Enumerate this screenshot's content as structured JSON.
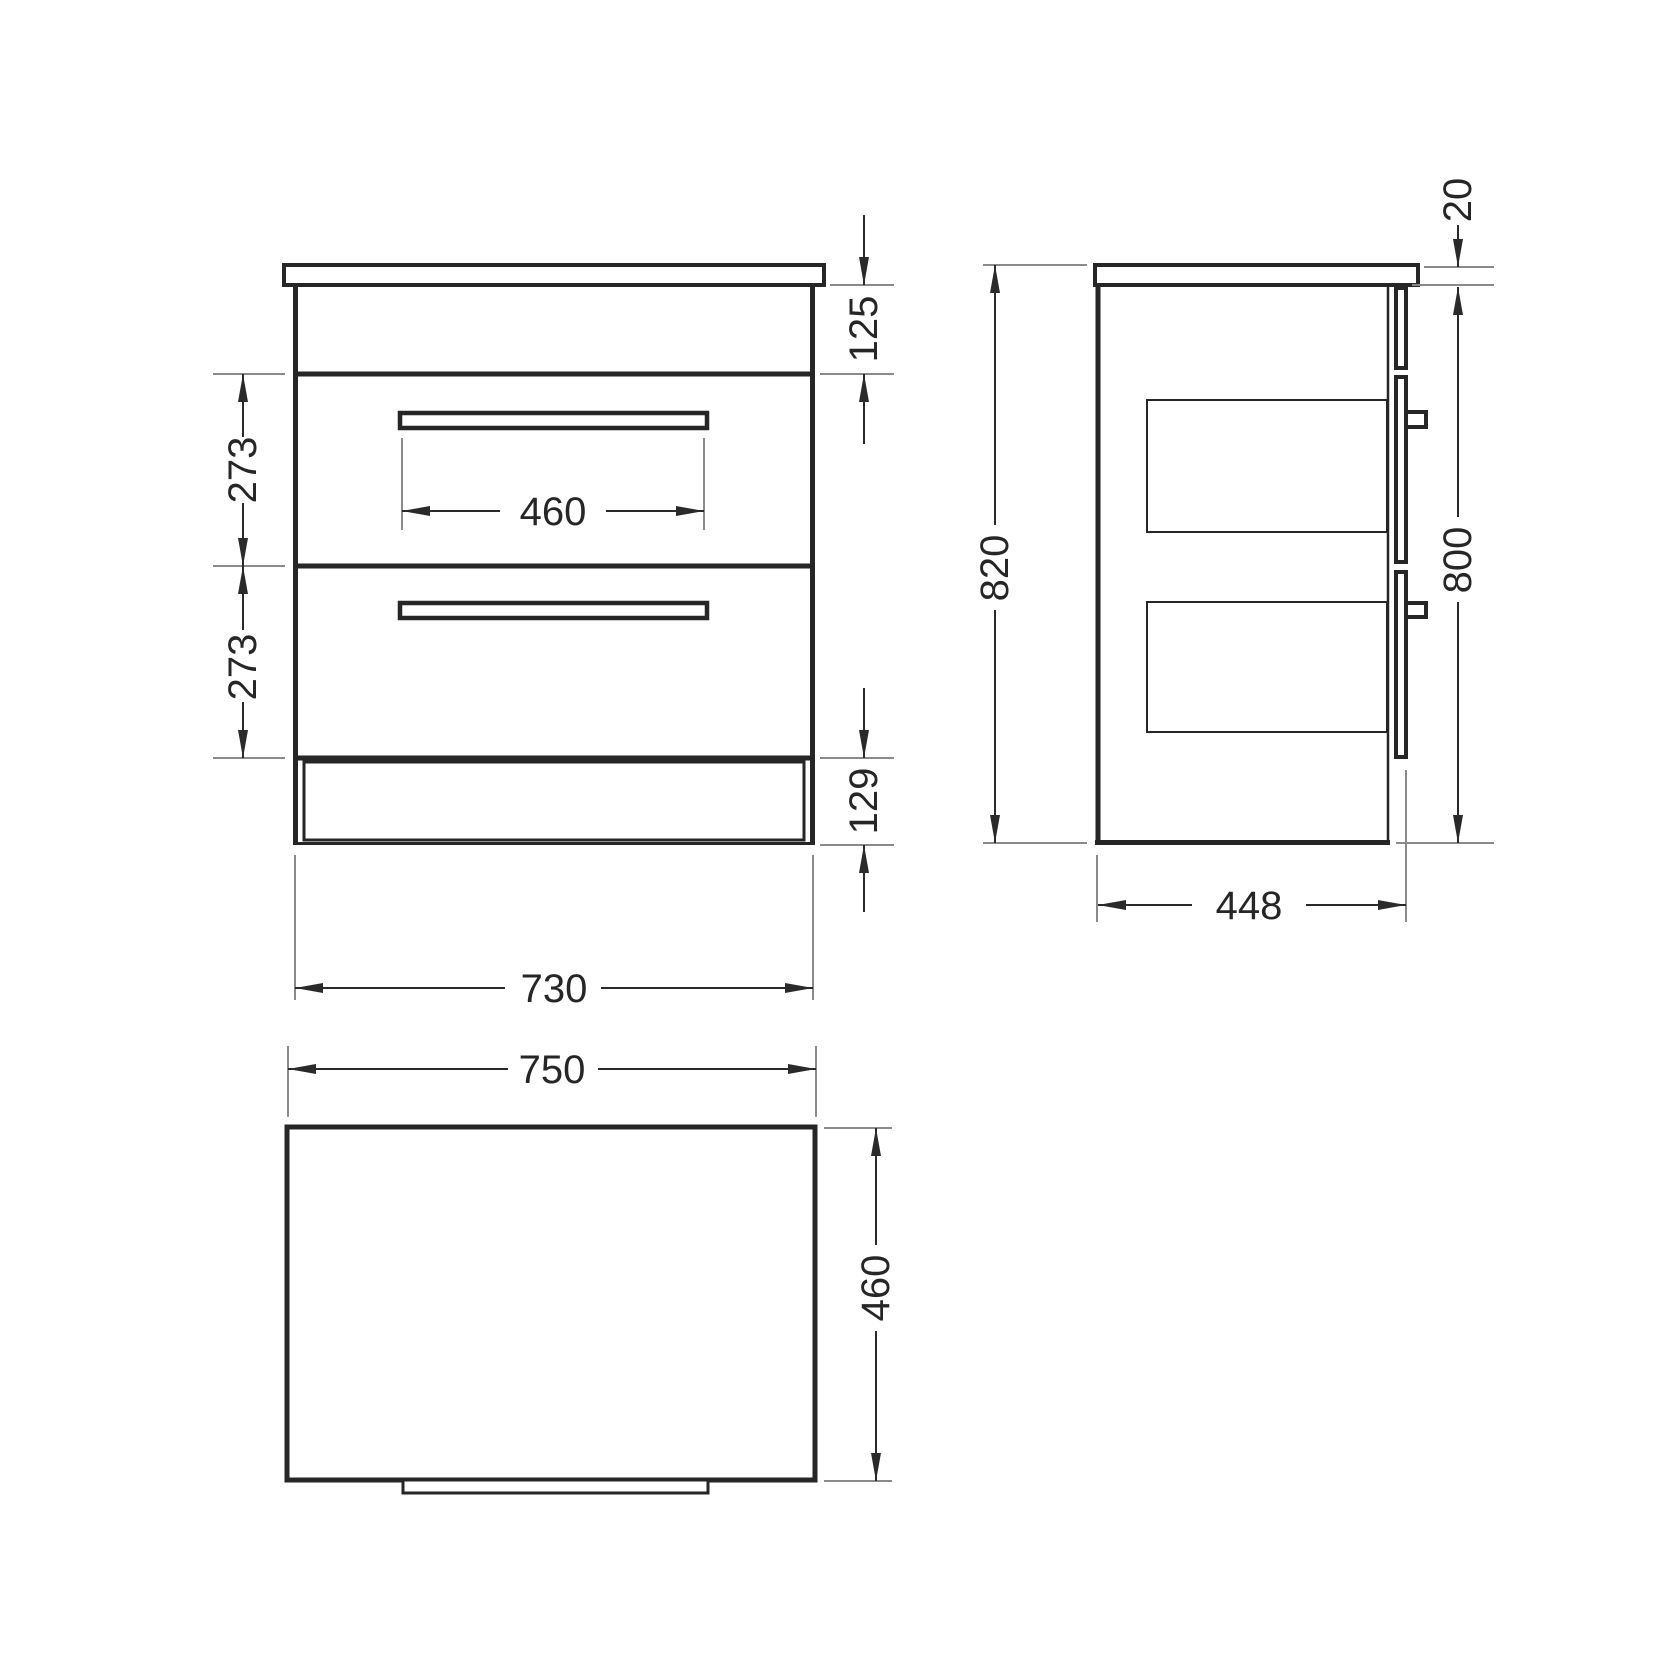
{
  "drawing": {
    "title": "two-drawer-cabinet-dimension-drawing",
    "background": "#ffffff",
    "line_color": "#262626",
    "extension_line_color": "#8a8a8a",
    "units": "mm",
    "views": {
      "front": {
        "name": "front-elevation",
        "dims": {
          "handle_width": "460",
          "top_rail_height": "125",
          "drawer1_height": "273",
          "drawer2_height": "273",
          "plinth_height": "129",
          "cabinet_width": "730"
        }
      },
      "side": {
        "name": "side-elevation",
        "dims": {
          "worktop_thickness": "20",
          "overall_height": "820",
          "front_panel_height": "800",
          "depth": "448"
        }
      },
      "top": {
        "name": "plan-view",
        "dims": {
          "worktop_width": "750",
          "worktop_depth": "460"
        }
      }
    }
  }
}
